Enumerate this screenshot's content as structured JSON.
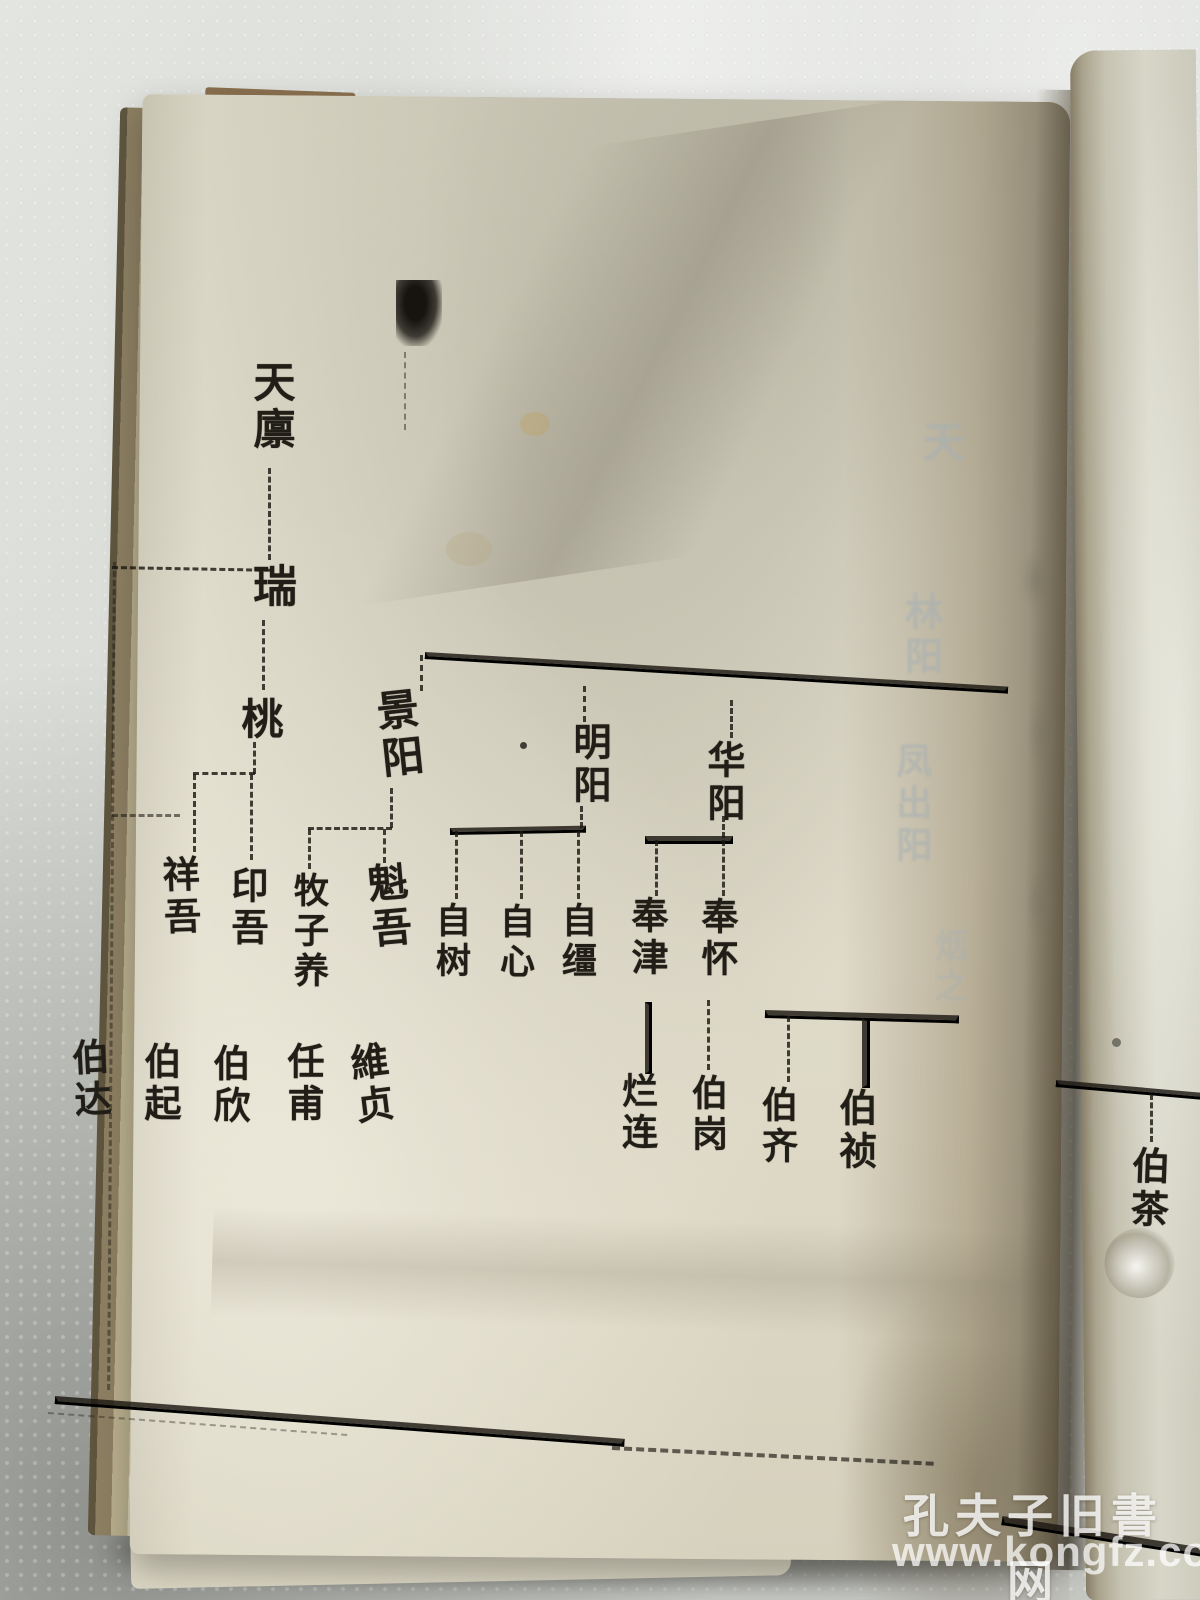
{
  "tree": {
    "tianlin": "天廪",
    "rui": "瑞",
    "tao": "桃",
    "jingyang": "景阳",
    "mingyang": "明阳",
    "huayang": "华阳",
    "xiangwu": "祥吾",
    "yinwu": "印吾",
    "muziyang": "牧子养",
    "kuiwu": "魁吾",
    "zishu": "自树",
    "zixin": "自心",
    "zijiang": "自缰",
    "fengjin": "奉津",
    "fenghuai": "奉怀",
    "boda": "伯达",
    "boqi": "伯起",
    "boxin": "伯欣",
    "renfu": "任甫",
    "weizhen": "維贞",
    "lanlian": "烂连",
    "bogang": "伯岗",
    "boqi2": "伯齐",
    "bozhen": "伯祯",
    "bocha": "伯茶"
  },
  "tree_edges": [
    [
      "天廪",
      "瑞"
    ],
    [
      "瑞",
      "桃"
    ],
    [
      "桃",
      "祥吾"
    ],
    [
      "桃",
      "印吾"
    ],
    [
      "景阳",
      "牧子养"
    ],
    [
      "景阳",
      "魁吾"
    ],
    [
      "明阳",
      "自树"
    ],
    [
      "明阳",
      "自心"
    ],
    [
      "明阳",
      "自缰"
    ],
    [
      "华阳",
      "奉津"
    ],
    [
      "华阳",
      "奉怀"
    ],
    [
      "祥吾",
      "伯达"
    ],
    [
      "祥吾",
      "伯起"
    ],
    [
      "印吾",
      "伯欣"
    ],
    [
      "牧子养",
      "任甫"
    ],
    [
      "魁吾",
      "維贞"
    ],
    [
      "奉津",
      "烂连"
    ],
    [
      "奉怀",
      "伯岗"
    ]
  ],
  "bleedthrough": {
    "col1": "天",
    "col2": "林阳",
    "col3": "凤出阳",
    "col4": "烟之"
  },
  "watermark": {
    "site_name": "孔夫子旧書网",
    "site_url": "www.kongfz.com"
  }
}
